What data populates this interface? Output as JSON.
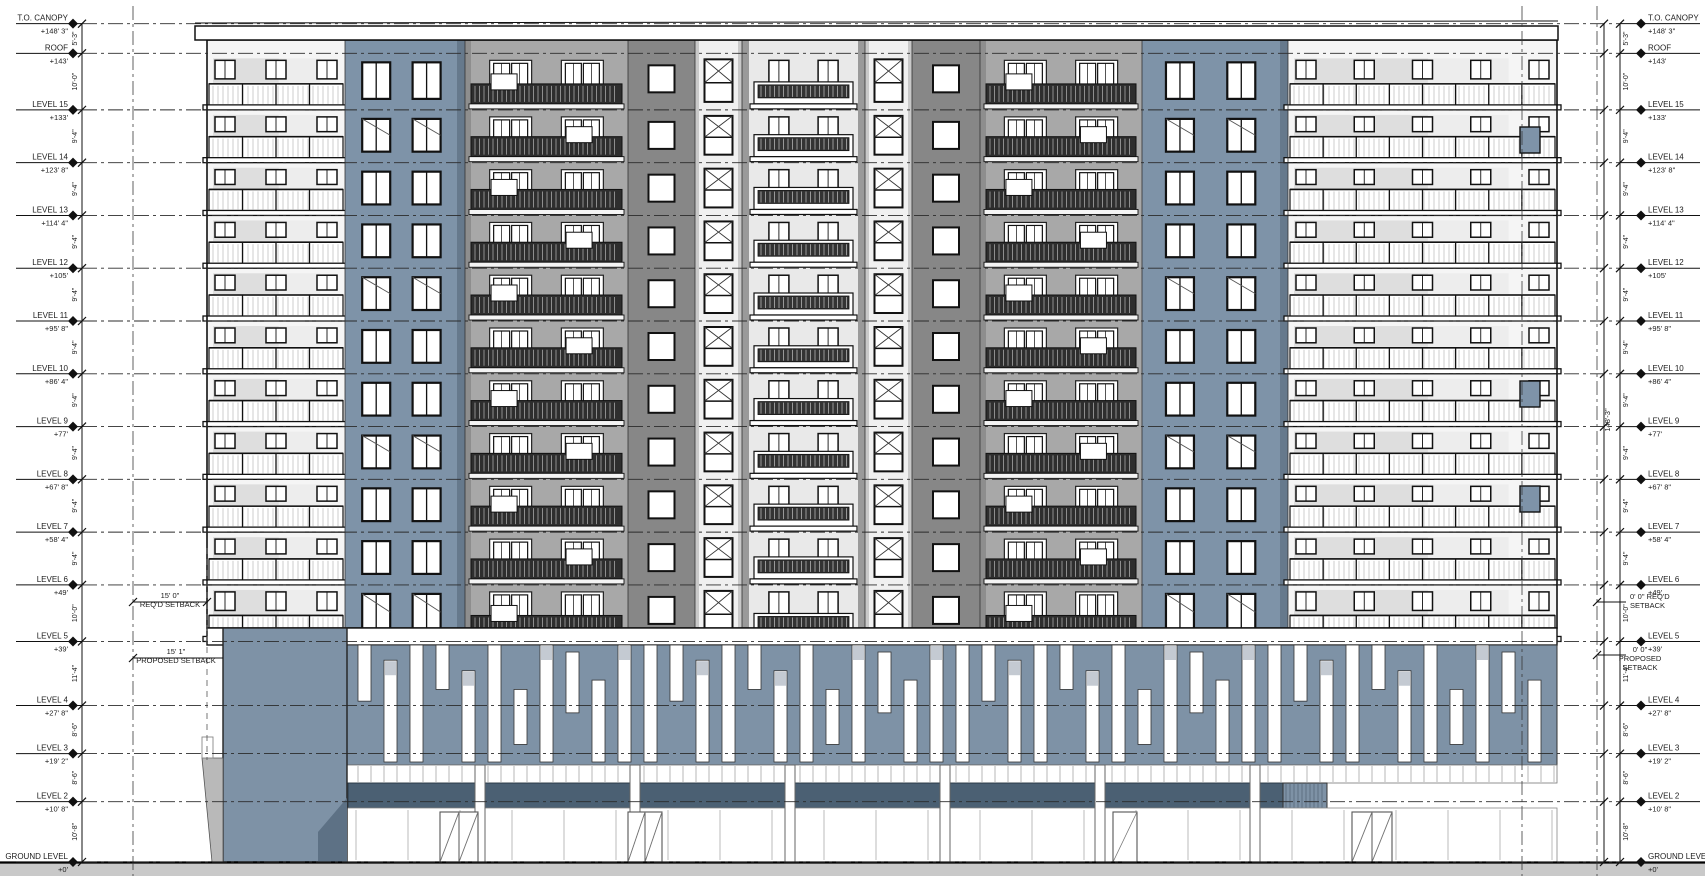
{
  "levels": [
    {
      "name": "T.O. CANOPY",
      "elev": "+148' 3\"",
      "ft": 148.25
    },
    {
      "name": "ROOF",
      "elev": "+143'",
      "ft": 143
    },
    {
      "name": "LEVEL 15",
      "elev": "+133'",
      "ft": 133
    },
    {
      "name": "LEVEL 14",
      "elev": "+123' 8\"",
      "ft": 123.6667
    },
    {
      "name": "LEVEL 13",
      "elev": "+114' 4\"",
      "ft": 114.3333
    },
    {
      "name": "LEVEL 12",
      "elev": "+105'",
      "ft": 105
    },
    {
      "name": "LEVEL 11",
      "elev": "+95' 8\"",
      "ft": 95.6667
    },
    {
      "name": "LEVEL 10",
      "elev": "+86' 4\"",
      "ft": 86.3333
    },
    {
      "name": "LEVEL 9",
      "elev": "+77'",
      "ft": 77
    },
    {
      "name": "LEVEL 8",
      "elev": "+67' 8\"",
      "ft": 67.6667
    },
    {
      "name": "LEVEL 7",
      "elev": "+58' 4\"",
      "ft": 58.3333
    },
    {
      "name": "LEVEL 6",
      "elev": "+49'",
      "ft": 49
    },
    {
      "name": "LEVEL 5",
      "elev": "+39'",
      "ft": 39
    },
    {
      "name": "LEVEL 4",
      "elev": "+27' 8\"",
      "ft": 27.6667
    },
    {
      "name": "LEVEL 3",
      "elev": "+19' 2\"",
      "ft": 19.1667
    },
    {
      "name": "LEVEL 2",
      "elev": "+10' 8\"",
      "ft": 10.6667
    },
    {
      "name": "GROUND LEVEL",
      "elev": "+0'",
      "ft": 0
    }
  ],
  "floor_dims": [
    "5'-3\"",
    "10'-0\"",
    "9'-4\"",
    "9'-4\"",
    "9'-4\"",
    "9'-4\"",
    "9'-4\"",
    "9'-4\"",
    "9'-4\"",
    "9'-4\"",
    "9'-4\"",
    "10'-0\"",
    "11'-4\"",
    "8'-6\"",
    "8'-6\"",
    "10'-8\""
  ],
  "overall_height_dim": "148'-3\"",
  "setbacks": {
    "left": [
      {
        "lines": [
          "15' 0\"",
          "REQ'D SETBACK"
        ]
      },
      {
        "lines": [
          "15' 1\"",
          "PROPOSED SETBACK"
        ]
      }
    ],
    "right": [
      {
        "lines": [
          "0' 0\" REQ'D",
          "SETBACK"
        ]
      },
      {
        "lines": [
          "0' 0\"",
          "PROPOSED",
          "SETBACK"
        ]
      }
    ]
  },
  "colors": {
    "accent_blue": "#7e93a8",
    "accent_blue_shade": "#66798c",
    "podium_blue": "#7e92a6",
    "podium_band_dark": "#4b6073",
    "gray_light": "#f5f5f5",
    "gray_mid": "#a8a8a8",
    "gray_dark": "#878787",
    "line": "#1c1c1c",
    "ground": "#c9c9c9"
  }
}
